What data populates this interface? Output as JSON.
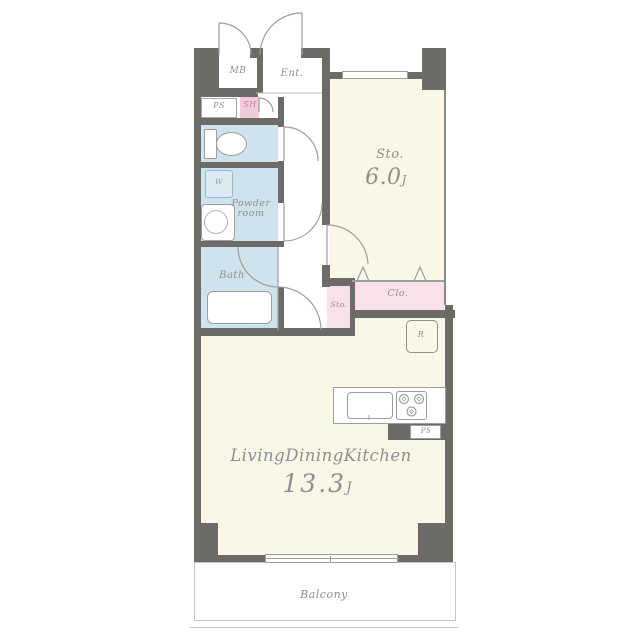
{
  "plan_title": "apartment-floor-plan",
  "rooms": {
    "mb": {
      "label": "MB"
    },
    "ent": {
      "label": "Ent."
    },
    "ps_top": {
      "label": "PS"
    },
    "sh": {
      "label": "SH"
    },
    "toilet": {
      "label": ""
    },
    "washer": {
      "label": "W"
    },
    "powder": {
      "line1": "Powder",
      "line2": "room"
    },
    "bath": {
      "label": "Bath"
    },
    "sto_main": {
      "label": "Sto.",
      "size": "6.0",
      "unit": "J"
    },
    "clo": {
      "label": "Clo."
    },
    "sto_small": {
      "label": "Sto."
    },
    "fridge": {
      "label": "R"
    },
    "ps_kitchen": {
      "label": "PS"
    },
    "ldk": {
      "label": "LivingDiningKitchen",
      "size": "13.3",
      "unit": "J"
    },
    "balcony": {
      "label": "Balcony"
    }
  },
  "colors": {
    "wall": "#6d6b68",
    "room_cream": "#faf7e6",
    "room_blue": "#cfe3ed",
    "room_pink": "#f8e1eb",
    "room_pink_deep": "#f2cbdb",
    "label_text": "#8f8f8f",
    "sh_text": "#cd7fa4",
    "line": "#9d9d9d",
    "balcony_border": "#c6c6c6"
  }
}
